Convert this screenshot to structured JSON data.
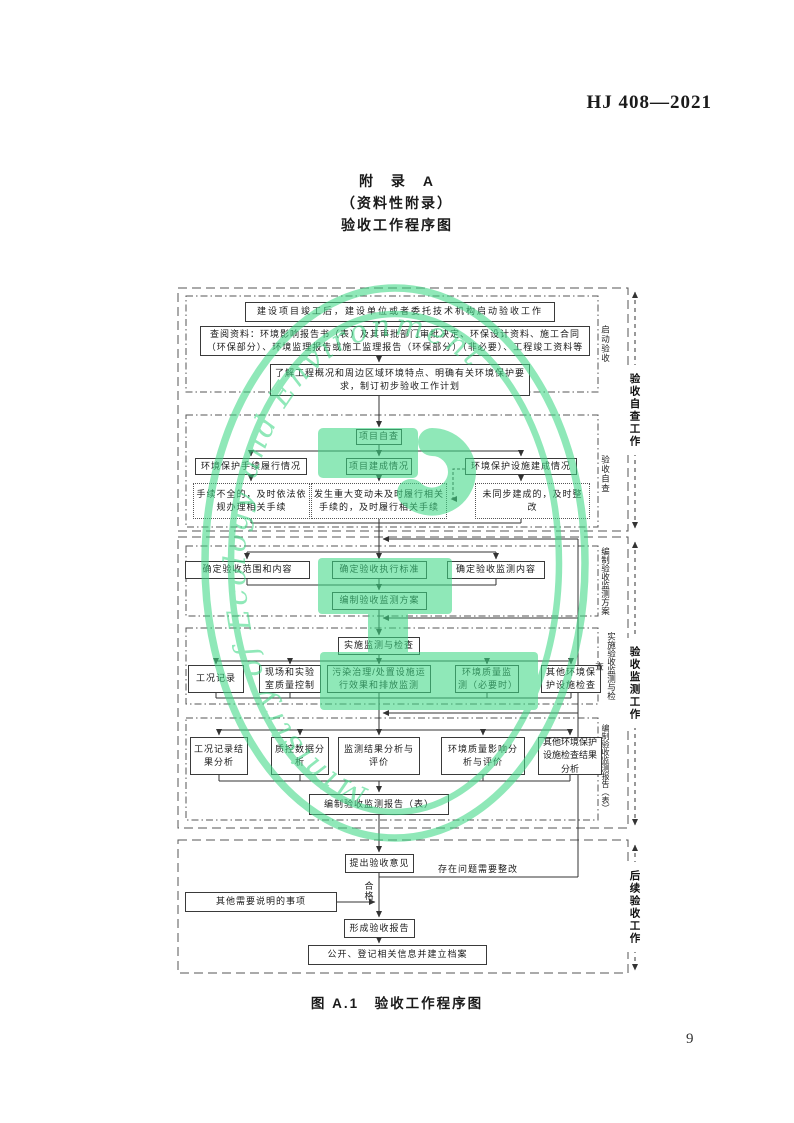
{
  "page": {
    "header": "HJ 408—2021",
    "title_line1": "附　录　A",
    "title_line2": "（资料性附录）",
    "title_line3": "验收工作程序图",
    "caption": "图 A.1　验收工作程序图",
    "page_number": "9"
  },
  "groups": {
    "g1": "验收自查工作",
    "g2": "验收监测工作",
    "g3": "后续验收工作"
  },
  "phases": {
    "p1": "启动验收",
    "p2": "验收自查",
    "p3": "编制验收监测方案",
    "p4": "实施验收监测与检查",
    "p5": "编制验收监测报告（表）"
  },
  "boxes": {
    "s1b1": "建设项目竣工后，建设单位或者委托技术机构启动验收工作",
    "s1b2": "查阅资料：环境影响报告书（表）及其审批部门审批决定、环保设计资料、施工合同（环保部分）、环境监理报告或施工监理报告（环保部分）（非必要）、工程竣工资料等",
    "s1b3": "了解工程概况和周边区域环境特点、明确有关环境保护要求，制订初步验收工作计划",
    "s2b0": "项目自查",
    "s2b1": "环境保护手续履行情况",
    "s2b2": "项目建成情况",
    "s2b3": "环境保护设施建成情况",
    "s2c1": "手续不全的，及时依法依规办理相关手续",
    "s2c2": "发生重大变动未及时履行相关手续的，及时履行相关手续",
    "s2c3": "未同步建成的，及时整改",
    "s3b1": "确定验收范围和内容",
    "s3b2": "确定验收执行标准",
    "s3b3": "确定验收监测内容",
    "s3b4": "编制验收监测方案",
    "s4b0": "实施监测与检查",
    "s4b1": "工况记录",
    "s4b2": "现场和实验室质量控制",
    "s4b3": "污染治理/处置设施运行效果和排放监测",
    "s4b4": "环境质量监测（必要时）",
    "s4b5": "其他环境保护设施检查",
    "s5b1": "工况记录结果分析",
    "s5b2": "质控数据分析",
    "s5b3": "监测结果分析与评价",
    "s5b4": "环境质量影响分析与评价",
    "s5b5": "其他环境保护设施检查结果分析",
    "s5b6": "编制验收监测报告（表）",
    "s6b1": "提出验收意见",
    "s6b2": "其他需要说明的事项",
    "s6b3": "形成验收报告",
    "s6b4": "公开、登记相关信息并建立档案",
    "pass_label": "合格",
    "rework_label": "存在问题需要整改"
  },
  "watermark": {
    "text": "Ministry of Ecology and Environment",
    "color": "#3fd986"
  }
}
